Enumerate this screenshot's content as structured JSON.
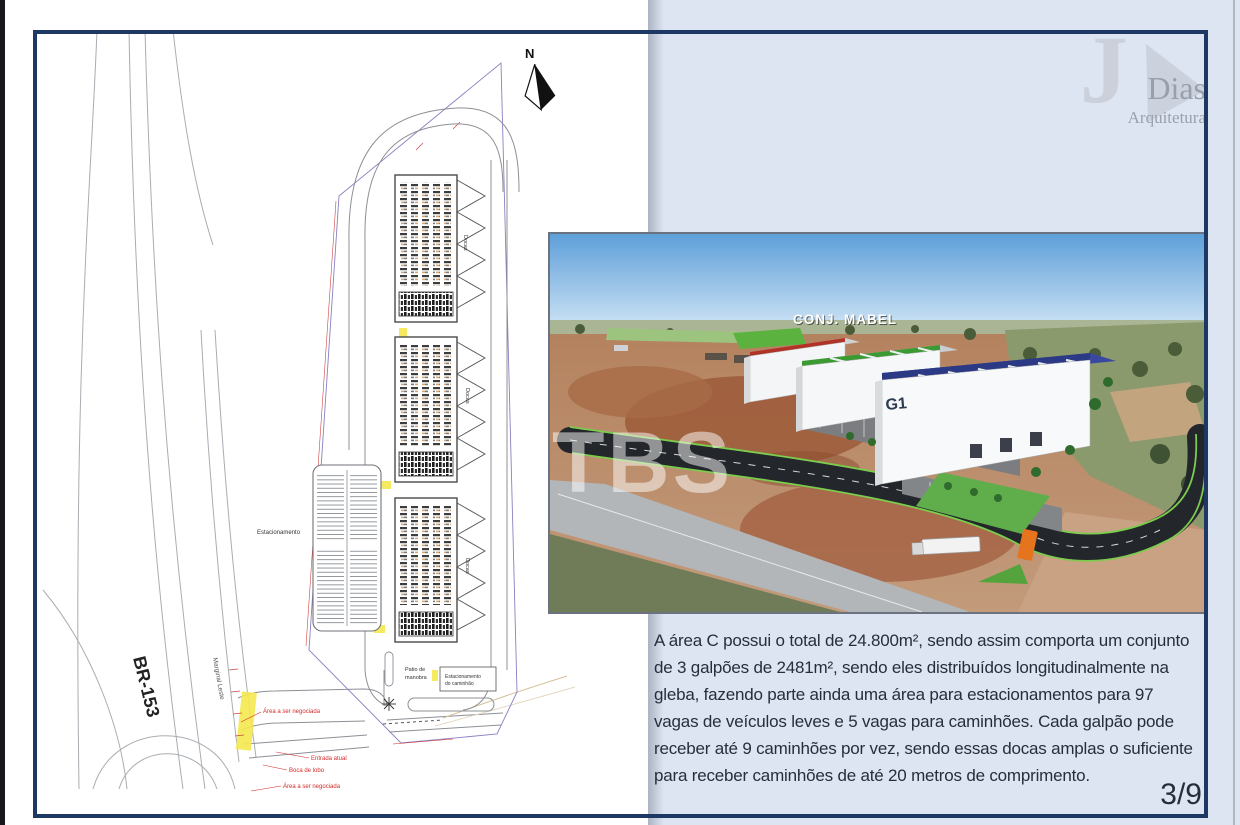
{
  "page": {
    "number_label": "3/9"
  },
  "logo": {
    "j": "J",
    "name": "Dias",
    "subtitle": "Arquitetura"
  },
  "description": {
    "text": "A área C possui o total de 24.800m², sendo assim comporta um conjunto\nde 3 galpões de 2481m², sendo eles distribuídos longitudinalmente na\ngleba, fazendo parte ainda uma área para estacionamentos para 97\nvagas de veículos leves e 5 vagas para caminhões. Cada galpão pode\nreceber até 9 caminhões por vez, sendo essas docas amplas o suficiente\npara receber caminhões de até 20 metros de comprimento."
  },
  "render": {
    "estate_label": "CONJ. MABEL",
    "building_label": "G1",
    "watermark": "TBS"
  },
  "site_plan": {
    "north_label": "N",
    "highway_label": "BR-153",
    "frontage_road_label": "Marginal Leste",
    "parking_label": "Estacionamento",
    "docks_label": "Docas",
    "yard_label_1": "Patio de",
    "yard_label_2": "manobra",
    "truck_parking_label_1": "Estacionamento",
    "truck_parking_label_2": "do caminhão",
    "annotations": {
      "area_negotiated": "Área a ser negociada",
      "entrance": "Entrada atual",
      "drain": "Boca de lobo"
    }
  }
}
